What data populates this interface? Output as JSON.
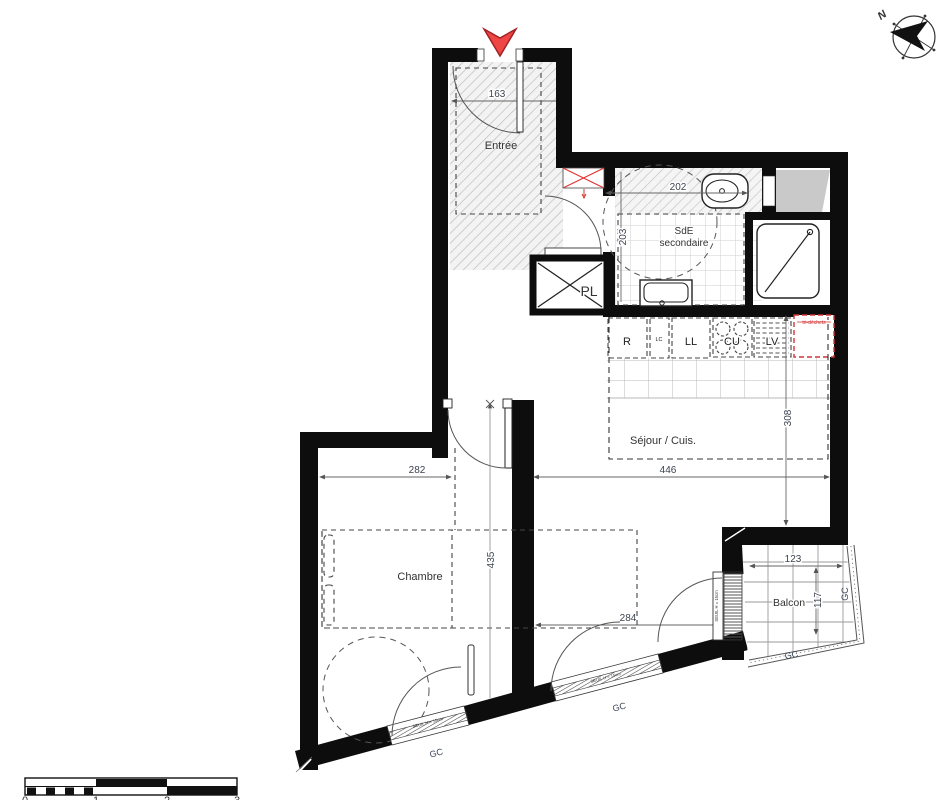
{
  "labels": {
    "entree": "Entrée",
    "sde1": "SdE",
    "sde2": "secondaire",
    "pl": "PL",
    "sejour": "Séjour / Cuis.",
    "chambre": "Chambre",
    "balcon": "Balcon"
  },
  "appliances": {
    "r": "R",
    "lc": "LC",
    "ll": "LL",
    "cu": "CU",
    "lv": "LV",
    "tri": "tri-déchets"
  },
  "dims": {
    "d163": "163",
    "d202": "202",
    "d203": "203",
    "d446": "446",
    "d308": "308",
    "d282": "282",
    "d435": "435",
    "d284": "284",
    "d123": "123",
    "d117": "117"
  },
  "annot": {
    "gc": "GC",
    "seuil": "SEUIL H = 15cm",
    "north": "N"
  },
  "scale": {
    "t0": "0",
    "t1": "1",
    "t2": "2",
    "t3": "3"
  },
  "colors": {
    "wall": "#0d0d0d",
    "entrance_arrow": "#ee4545",
    "reserved_red": "#d23333"
  }
}
